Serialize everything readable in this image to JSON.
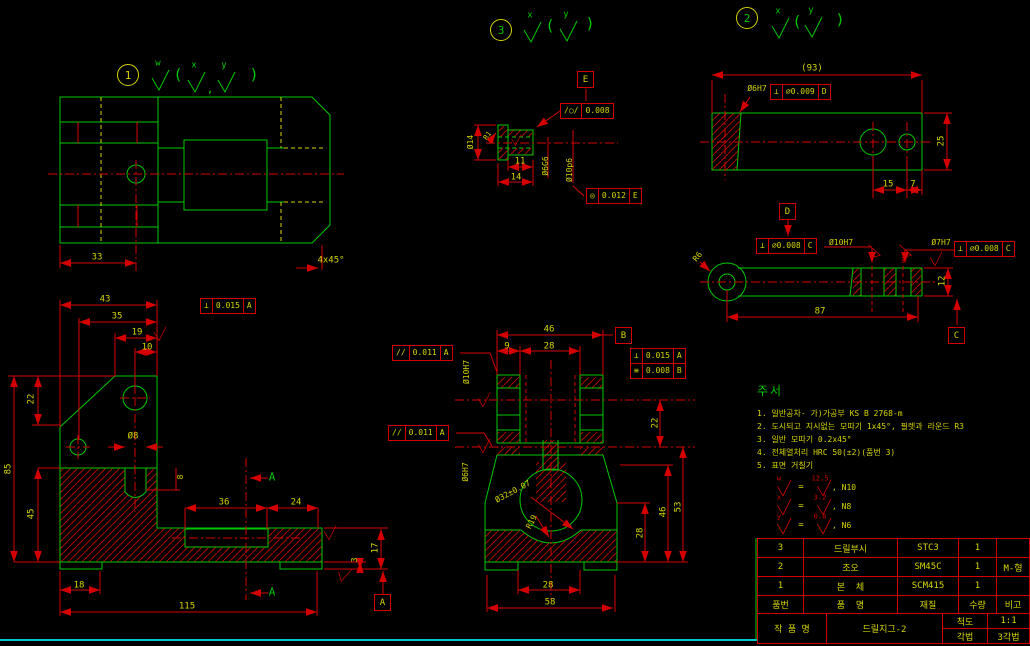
{
  "colors": {
    "geometry_green": "#00c800",
    "dimension_red": "#d40000",
    "text_yellow": "#d4d400",
    "frame_cyan": "#00c8c8",
    "background": "#000000"
  },
  "callouts": [
    {
      "t": "1",
      "x": 127,
      "y": 74,
      "nc": "y"
    },
    {
      "t": "3",
      "x": 500,
      "y": 29,
      "nc": "g"
    },
    {
      "t": "2",
      "x": 746,
      "y": 17,
      "nc": "g"
    }
  ],
  "labels": [
    {
      "t": "33",
      "x": 97,
      "y": 258
    },
    {
      "t": "4x45°",
      "x": 331,
      "y": 261
    },
    {
      "t": "w",
      "x": 158,
      "y": 64,
      "c": "g"
    },
    {
      "t": "x",
      "x": 194,
      "y": 66,
      "c": "g"
    },
    {
      "t": "y",
      "x": 224,
      "y": 66,
      "c": "g"
    },
    {
      "t": "(",
      "x": 178,
      "y": 75,
      "c": "g",
      "s": 15
    },
    {
      "t": ")",
      "x": 254,
      "y": 75,
      "c": "g",
      "s": 15
    },
    {
      "t": ",",
      "x": 210,
      "y": 89,
      "c": "g",
      "s": 11
    },
    {
      "t": "x",
      "x": 530,
      "y": 16,
      "c": "g"
    },
    {
      "t": "y",
      "x": 566,
      "y": 15,
      "c": "g"
    },
    {
      "t": "(",
      "x": 550,
      "y": 26,
      "c": "g",
      "s": 15
    },
    {
      "t": ")",
      "x": 590,
      "y": 24,
      "c": "g",
      "s": 15
    },
    {
      "t": "x",
      "x": 778,
      "y": 12,
      "c": "g"
    },
    {
      "t": "y",
      "x": 811,
      "y": 11,
      "c": "g"
    },
    {
      "t": "(",
      "x": 797,
      "y": 22,
      "c": "g",
      "s": 15
    },
    {
      "t": ")",
      "x": 840,
      "y": 20,
      "c": "g",
      "s": 15
    },
    {
      "t": "43",
      "x": 105,
      "y": 300
    },
    {
      "t": "35",
      "x": 117,
      "y": 317
    },
    {
      "t": "19",
      "x": 137,
      "y": 333
    },
    {
      "t": "10",
      "x": 147,
      "y": 348
    },
    {
      "t": "22",
      "x": 32,
      "y": 399,
      "r": -90
    },
    {
      "t": "85",
      "x": 9,
      "y": 469,
      "r": -90
    },
    {
      "t": "45",
      "x": 32,
      "y": 514,
      "r": -90
    },
    {
      "t": "Ø8",
      "x": 133,
      "y": 437
    },
    {
      "t": "8",
      "x": 181,
      "y": 477,
      "r": -90,
      "s": 8
    },
    {
      "t": "36",
      "x": 224,
      "y": 503
    },
    {
      "t": "24",
      "x": 296,
      "y": 503
    },
    {
      "t": "17",
      "x": 376,
      "y": 548,
      "r": -90
    },
    {
      "t": "3",
      "x": 355,
      "y": 560,
      "r": -90,
      "s": 8
    },
    {
      "t": "18",
      "x": 79,
      "y": 586
    },
    {
      "t": "115",
      "x": 187,
      "y": 607
    },
    {
      "t": "A",
      "x": 272,
      "y": 477,
      "c": "g",
      "s": 11
    },
    {
      "t": "A",
      "x": 272,
      "y": 592,
      "c": "g",
      "s": 11
    },
    {
      "t": "46",
      "x": 549,
      "y": 330
    },
    {
      "t": "9",
      "x": 507,
      "y": 347
    },
    {
      "t": "28",
      "x": 549,
      "y": 347
    },
    {
      "t": "Ø10H7",
      "x": 467,
      "y": 372,
      "r": -90,
      "s": 8
    },
    {
      "t": "Ø6H7",
      "x": 466,
      "y": 472,
      "r": -90,
      "s": 8
    },
    {
      "t": "22",
      "x": 656,
      "y": 423,
      "r": -90
    },
    {
      "t": "Ø32±0.07",
      "x": 513,
      "y": 492,
      "r": -28,
      "s": 8
    },
    {
      "t": "R19",
      "x": 532,
      "y": 522,
      "r": -62,
      "s": 8
    },
    {
      "t": "28",
      "x": 641,
      "y": 533,
      "r": -90
    },
    {
      "t": "46",
      "x": 664,
      "y": 512,
      "r": -90
    },
    {
      "t": "53",
      "x": 679,
      "y": 507,
      "r": -90
    },
    {
      "t": "28",
      "x": 548,
      "y": 586
    },
    {
      "t": "58",
      "x": 550,
      "y": 603
    },
    {
      "t": "(93)",
      "x": 812,
      "y": 69
    },
    {
      "t": "Ø6H7",
      "x": 757,
      "y": 89,
      "s": 8
    },
    {
      "t": "15",
      "x": 888,
      "y": 185
    },
    {
      "t": "7",
      "x": 913,
      "y": 185
    },
    {
      "t": "25",
      "x": 942,
      "y": 141,
      "r": -90
    },
    {
      "t": "Ø10H7",
      "x": 841,
      "y": 243,
      "s": 8
    },
    {
      "t": "Ø7H7",
      "x": 941,
      "y": 243,
      "s": 8
    },
    {
      "t": "R6",
      "x": 698,
      "y": 257,
      "r": -50,
      "s": 8
    },
    {
      "t": "87",
      "x": 820,
      "y": 312
    },
    {
      "t": "12",
      "x": 943,
      "y": 281,
      "r": -90
    },
    {
      "t": "Ø14",
      "x": 471,
      "y": 142,
      "r": -90,
      "s": 8
    },
    {
      "t": "R1",
      "x": 488,
      "y": 136,
      "r": -55,
      "s": 7
    },
    {
      "t": "11",
      "x": 520,
      "y": 162
    },
    {
      "t": "14",
      "x": 516,
      "y": 178
    },
    {
      "t": "Ø6G6",
      "x": 546,
      "y": 166,
      "r": -90,
      "s": 8
    },
    {
      "t": "Ø10p6",
      "x": 570,
      "y": 170,
      "r": -90,
      "s": 8
    }
  ],
  "checks": [
    {
      "x": 160,
      "y": 80,
      "c": "g"
    },
    {
      "x": 196,
      "y": 82,
      "c": "g"
    },
    {
      "x": 226,
      "y": 82,
      "c": "g"
    },
    {
      "x": 532,
      "y": 32,
      "c": "g"
    },
    {
      "x": 568,
      "y": 31,
      "c": "g"
    },
    {
      "x": 780,
      "y": 28,
      "c": "g"
    },
    {
      "x": 813,
      "y": 27,
      "c": "g"
    },
    {
      "x": 160,
      "y": 334,
      "c": "r",
      "s": 0.7
    },
    {
      "x": 330,
      "y": 533,
      "c": "r",
      "s": 0.7
    },
    {
      "x": 344,
      "y": 575,
      "c": "r",
      "s": 0.7,
      "r": 15
    },
    {
      "x": 484,
      "y": 400,
      "c": "r",
      "s": 0.7
    },
    {
      "x": 484,
      "y": 446,
      "c": "r",
      "s": 0.7
    },
    {
      "x": 874,
      "y": 253,
      "c": "r",
      "s": 0.7,
      "r": -75
    },
    {
      "x": 905,
      "y": 253,
      "c": "r",
      "s": 0.7,
      "r": -75
    },
    {
      "x": 936,
      "y": 259,
      "c": "r",
      "s": 0.7
    },
    {
      "x": 516,
      "y": 140,
      "c": "r",
      "s": 0.55
    }
  ],
  "fcfs": [
    {
      "x": 200,
      "y": 298,
      "cells": [
        "⊥",
        "0.015",
        "A"
      ]
    },
    {
      "x": 392,
      "y": 345,
      "cells": [
        "//",
        "0.011",
        "A"
      ]
    },
    {
      "x": 388,
      "y": 425,
      "cells": [
        "//",
        "0.011",
        "A"
      ]
    },
    {
      "x": 630,
      "y": 348,
      "cells": [
        "⊥",
        "0.015",
        "A"
      ]
    },
    {
      "x": 630,
      "y": 363,
      "cells": [
        "≡",
        "0.008",
        "B"
      ]
    },
    {
      "x": 770,
      "y": 84,
      "cells": [
        "⊥",
        "∅0.009",
        "D"
      ]
    },
    {
      "x": 756,
      "y": 238,
      "cells": [
        "⊥",
        "∅0.008",
        "C"
      ]
    },
    {
      "x": 954,
      "y": 241,
      "cells": [
        "⊥",
        "∅0.008",
        "C"
      ]
    },
    {
      "x": 560,
      "y": 103,
      "cells": [
        "/○/",
        "0.008"
      ]
    },
    {
      "x": 586,
      "y": 188,
      "cells": [
        "◎",
        "0.012",
        "E"
      ]
    }
  ],
  "datums": [
    {
      "t": "A",
      "x": 374,
      "y": 594
    },
    {
      "t": "B",
      "x": 615,
      "y": 327
    },
    {
      "t": "C",
      "x": 948,
      "y": 327
    },
    {
      "t": "D",
      "x": 779,
      "y": 203
    },
    {
      "t": "E",
      "x": 577,
      "y": 71
    }
  ],
  "notes": {
    "title": "주서",
    "items": [
      "1. 일반공차- 가)가공부 KS B 2768-m",
      "2. 도시되고 지시없는 모따기 1x45°, 필렛과 라운드 R3",
      "3. 일반 모따기 0.2x45°",
      "4. 전체열처리 HRC 50(±2)(품번 3)",
      "5. 표면 거칠기"
    ]
  },
  "finish_legend": [
    {
      "letter": "w",
      "value": "12.5",
      "grade": "N10"
    },
    {
      "letter": "x",
      "value": "3.2",
      "grade": "N8"
    },
    {
      "letter": "y",
      "value": "0.8",
      "grade": "N6"
    }
  ],
  "titleblock": {
    "rows": [
      {
        "no": "3",
        "name": "드릴부시",
        "mat": "STC3",
        "qty": "1",
        "note": ""
      },
      {
        "no": "2",
        "name": "조오",
        "mat": "SM45C",
        "qty": "1",
        "note": "M-형"
      },
      {
        "no": "1",
        "name": "본  체",
        "mat": "SCM415",
        "qty": "1",
        "note": ""
      }
    ],
    "header": {
      "no": "품번",
      "name": "품  명",
      "mat": "재질",
      "qty": "수량",
      "note": "비고"
    },
    "footer": {
      "label": "작 품 명",
      "title": "드릴지그-2",
      "scale_label": "척도",
      "scale": "1:1",
      "method_label": "각법",
      "method": "3각법"
    }
  }
}
